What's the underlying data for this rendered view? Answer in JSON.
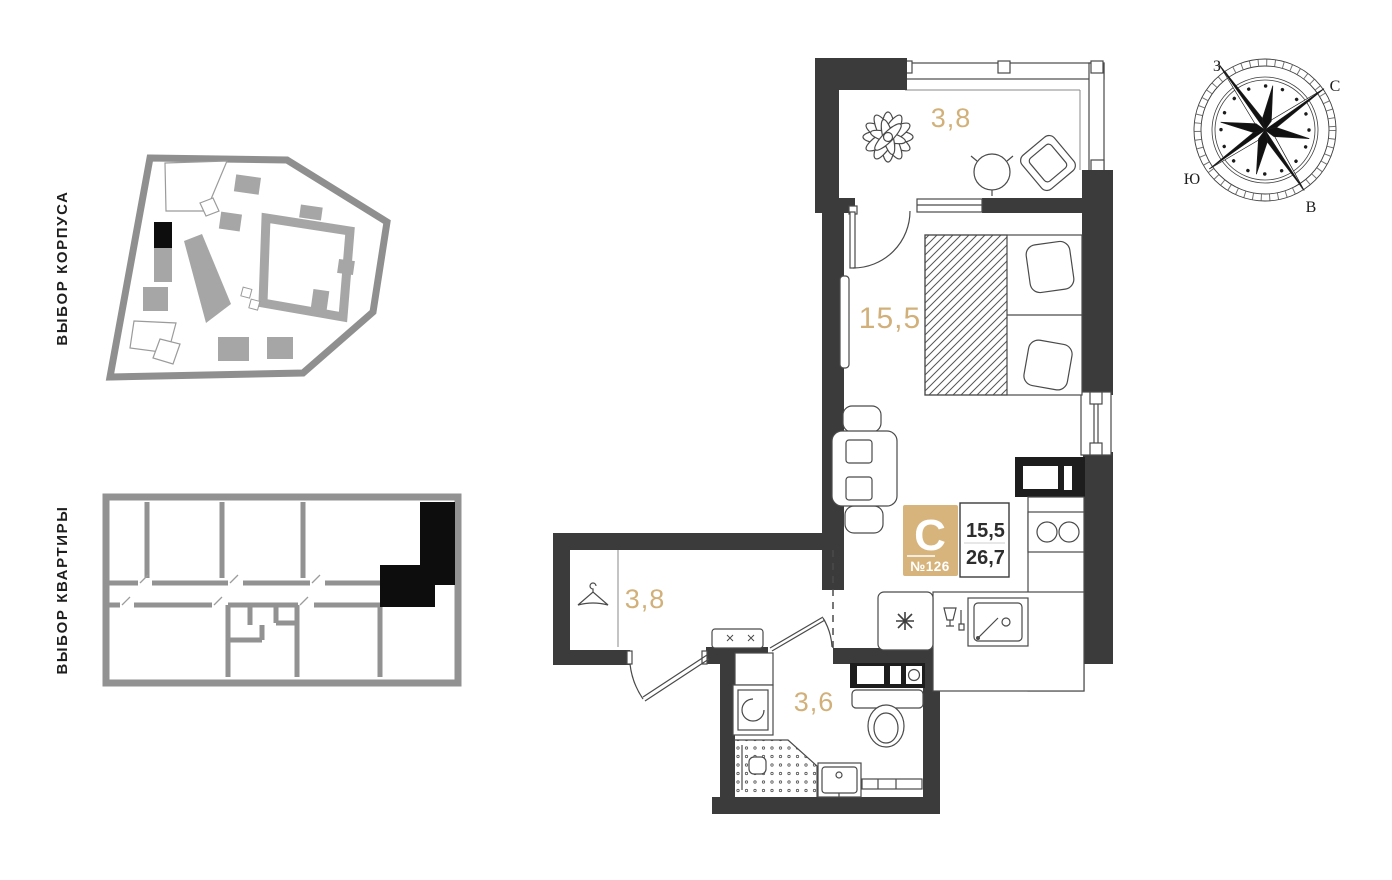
{
  "sidebar": {
    "building_selector_label": "ВЫБОР КОРПУСА",
    "apartment_selector_label": "ВЫБОР КВАРТИРЫ"
  },
  "compass": {
    "north": "С",
    "south": "Ю",
    "west": "З",
    "east": "В"
  },
  "plan": {
    "areas": {
      "balcony": "3,8",
      "main_room": "15,5",
      "hallway": "3,8",
      "bathroom": "3,6"
    },
    "badge": {
      "apartment_type": "С",
      "apartment_number": "№126",
      "living_area": "15,5",
      "total_area": "26,7"
    }
  },
  "colors": {
    "accent_gold": "#d2b07a",
    "badge_fill": "#d7b47b",
    "wall_dark": "#3b3b3b",
    "minimap_gray": "#9a9a9a",
    "selected_black": "#0d0d0d"
  }
}
